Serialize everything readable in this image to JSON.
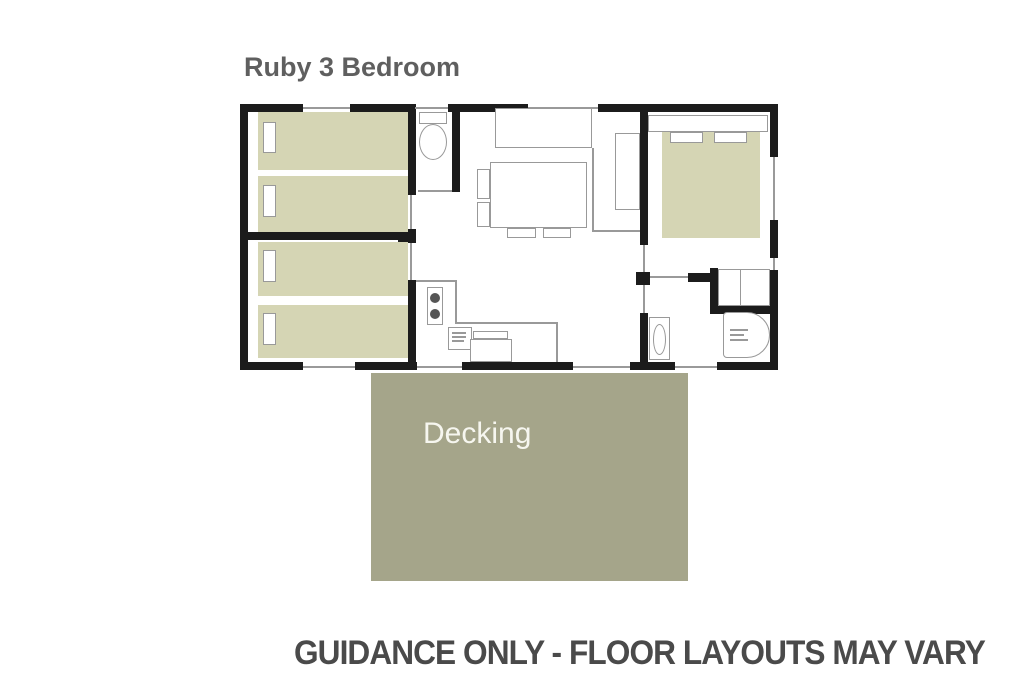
{
  "title": {
    "text": "Ruby 3 Bedroom"
  },
  "decking": {
    "label": "Decking"
  },
  "caption": {
    "text": "GUIDANCE ONLY - FLOOR LAYOUTS MAY VARY"
  },
  "colors": {
    "wall": "#1c1c1c",
    "bed_fill": "#d5d5b4",
    "decking_fill": "#a5a58a",
    "furniture_outline": "#999999",
    "opening_line": "#9a9a9a",
    "title_text": "#5f5f5f",
    "caption_text": "#4a4a4a",
    "decking_text": "#f6f6ef",
    "background": "#ffffff"
  }
}
